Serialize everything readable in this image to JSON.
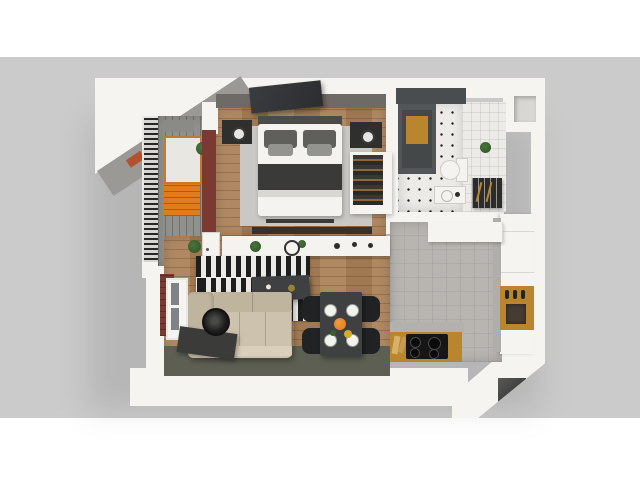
{
  "scene": {
    "type": "3d-apartment-floor-plan-render",
    "description": "Top-down 3D dollhouse render of a one-bedroom apartment on a gray backdrop with white bands above and below",
    "visible_text": "",
    "bands": {
      "top": "#ffffff",
      "canvas": "#cbcbcb",
      "bottom": "#ffffff"
    }
  },
  "rooms": {
    "balcony": {
      "name": "Balcony",
      "items": [
        "louver-screen",
        "lounge-chair",
        "outdoor-rug",
        "plants",
        "planter"
      ]
    },
    "bedroom": {
      "name": "Bedroom",
      "items": [
        "double-bed",
        "pillows",
        "blanket",
        "rug",
        "nightstand-left",
        "nightstand-right",
        "table-lamps",
        "tv-panel",
        "wardrobe-shelf",
        "dresser",
        "foot-bench"
      ]
    },
    "bathroom": {
      "name": "Bathroom",
      "items": [
        "shower",
        "wood-bath-mat",
        "toilet",
        "sink",
        "plant-shelf",
        "dotted-tile-floor"
      ]
    },
    "hallway": {
      "name": "Hallway",
      "items": [
        "tall-cabinet",
        "dish-rack",
        "corner-niche"
      ]
    },
    "kitchen": {
      "name": "Kitchen",
      "items": [
        "wall-cabinets",
        "tall-cabinets",
        "wine-niche",
        "cooktop",
        "cutting-boards",
        "countertop",
        "duct-opening"
      ]
    },
    "living": {
      "name": "Living / Dining Room",
      "items": [
        "sideboard",
        "striped-rug",
        "coffee-table",
        "sofa",
        "floor-fan",
        "radiator-bench",
        "window",
        "dining-table",
        "dining-chairs",
        "place-settings",
        "fruit-bowl"
      ]
    }
  },
  "palette": {
    "bgband": "#ffffff",
    "canvas": "#cbcbcb",
    "wall": "#f5f4f1",
    "wallshade": "#e3e1de",
    "slab": "#9b9996",
    "brick": "#b3502e",
    "wood": "#aa8057",
    "deck": "#90908c",
    "louverdark": "#272727",
    "louverlight": "#d6d5d2",
    "maroon": "#7a3a31",
    "ruggray": "#c9c8c4",
    "white": "#f4f3f0",
    "blanket": "#3a3a38",
    "pillowdark": "#5f5f5c",
    "pillowlight": "#93938f",
    "darkfurn": "#2f2f2d",
    "wallface": "#6e6a66",
    "tv": "#2b2d2f",
    "tile": "#ecebe8",
    "shower": "#535658",
    "showerinner": "#454849",
    "oak": "#b9862f",
    "oakdark": "#453c33",
    "grayfloor": "#b8b5b1",
    "countergray": "#b0aeaa",
    "cooktop": "#161616",
    "rugblack": "#1e1e1e",
    "rugwhite": "#eceae6",
    "sofa": "#cdc2ad",
    "sofashade": "#bfb49e",
    "sofalip": "#d8cfbc",
    "olive": "#5d5f53",
    "table": "#3e4042",
    "chair": "#202224",
    "plate": "#f2f2ef",
    "fruit": "#e07b1f",
    "yellow": "#d2ab2b",
    "bottlegreen": "#3c5e2a",
    "plant": "#47763a",
    "plantdark": "#2f4f26",
    "duct": "#3c3c3a",
    "nichein": "#d9d7d3",
    "fan": "#1a1a1a",
    "glass": "#7e8486"
  }
}
